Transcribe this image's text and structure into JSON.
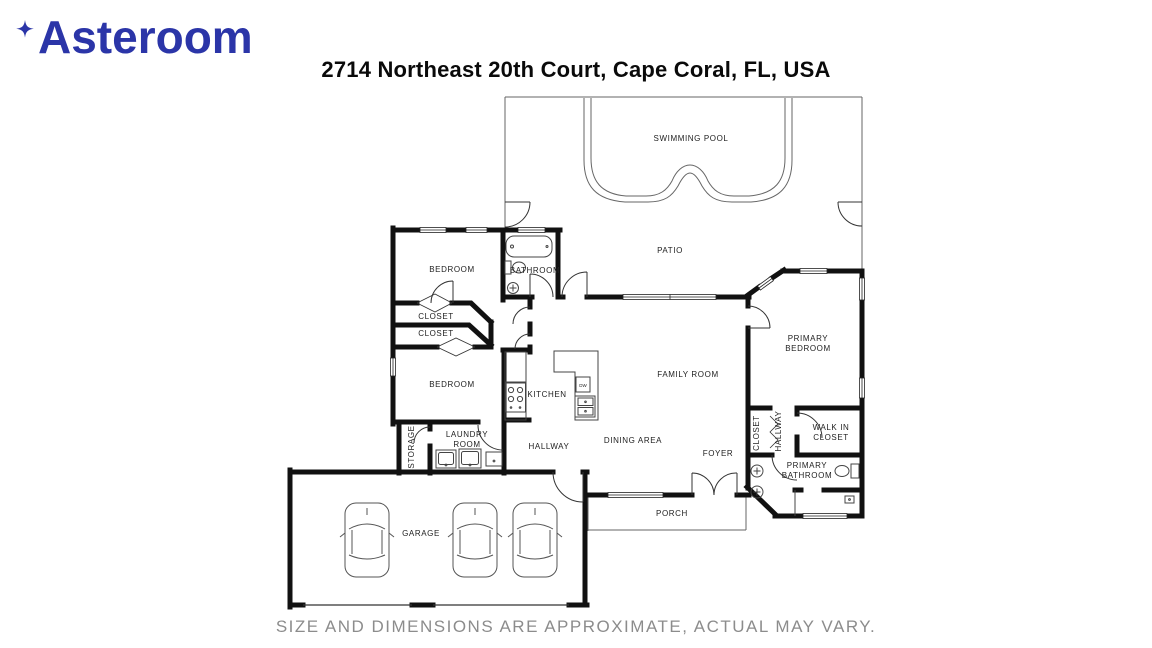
{
  "header": {
    "brand": "Asteroom",
    "title": "2714 Northeast 20th Court, Cape Coral, FL, USA"
  },
  "colors": {
    "brand_blue": "#2B35A8",
    "wall_black": "#111111",
    "label_gray": "#222222",
    "disclaimer_gray": "#8c8c8c"
  },
  "floorplan": {
    "labels": [
      "SWIMMING POOL",
      "PATIO",
      "BEDROOM",
      "BATHROOM",
      "CLOSET",
      "CLOSET",
      "BEDROOM",
      "KITCHEN",
      "FAMILY ROOM",
      "PRIMARY",
      "BEDROOM",
      "STORAGE",
      "LAUNDRY",
      "ROOM",
      "HALLWAY",
      "DINING AREA",
      "FOYER",
      "CLOSET",
      "HALLWAY",
      "WALK IN",
      "CLOSET",
      "PRIMARY",
      "BATHROOM",
      "PORCH",
      "GARAGE",
      "DW"
    ]
  },
  "footer": {
    "disclaimer": "SIZE AND DIMENSIONS ARE APPROXIMATE, ACTUAL MAY VARY."
  }
}
